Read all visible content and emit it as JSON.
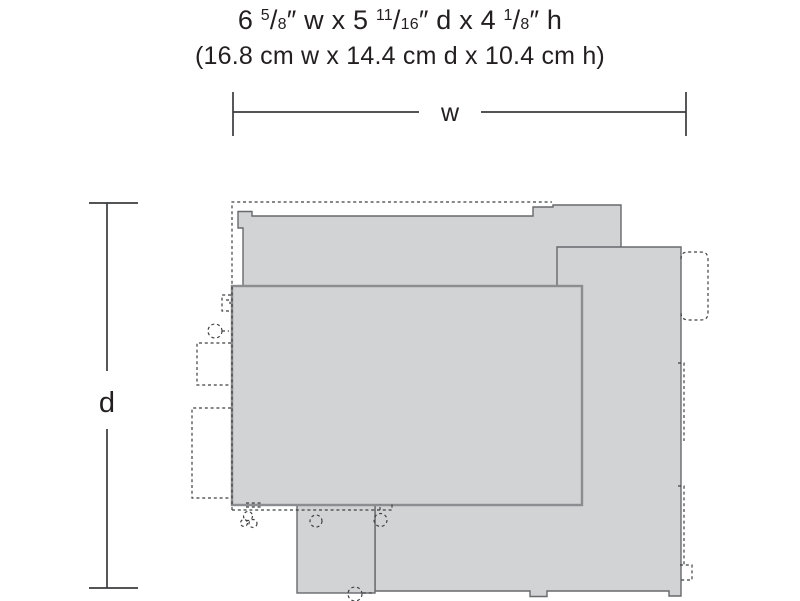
{
  "title": {
    "line1_parts": [
      {
        "text": "6 "
      },
      {
        "text": "5"
      },
      {
        "text": "/"
      },
      {
        "text": "8"
      },
      {
        "text": "″ w x 5 "
      },
      {
        "text": "11"
      },
      {
        "text": "/"
      },
      {
        "text": "16"
      },
      {
        "text": "″ d x 4 "
      },
      {
        "text": "1"
      },
      {
        "text": "/"
      },
      {
        "text": "8"
      },
      {
        "text": "″ h"
      }
    ],
    "line2": "(16.8 cm w x 14.4 cm d x 10.4 cm h)"
  },
  "dimension_labels": {
    "width": "w",
    "depth": "d"
  },
  "colors": {
    "background": "#ffffff",
    "shape_fill": "#d2d3d5",
    "shape_stroke": "#67696c",
    "base_rect_stroke": "#8b8d90",
    "dashed_stroke": "#3f4042",
    "dimension_line": "#3a3b3d",
    "text": "#231f20"
  }
}
